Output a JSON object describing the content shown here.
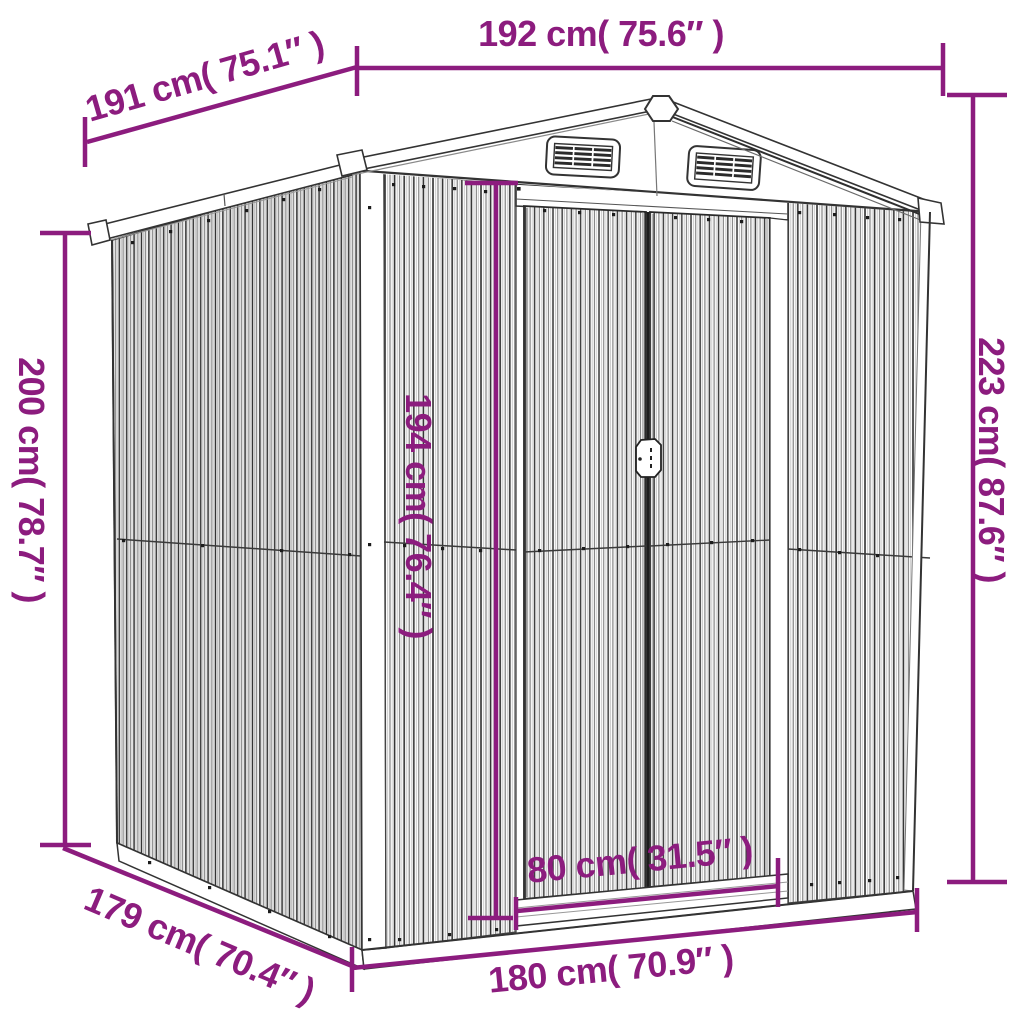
{
  "figure": {
    "kind": "product-dimension-diagram",
    "subject": "metal garden shed line drawing",
    "background_color": "#ffffff",
    "accent_color": "#8C1C7E",
    "drawing_line_color": "#333333"
  },
  "dimensions": {
    "roof_width_top": "192 cm( 75.6″ )",
    "roof_depth_top_left": "191 cm( 75.1″ )",
    "wall_height_left": "200 cm( 78.7″ )",
    "total_height_right": "223 cm( 87.6″ )",
    "door_height_center": "194 cm( 76.4″ )",
    "door_width": "80 cm( 31.5″ )",
    "base_width_bottom": "180 cm( 70.9″ )",
    "base_depth_bottom_left": "179 cm( 70.4″ )"
  }
}
